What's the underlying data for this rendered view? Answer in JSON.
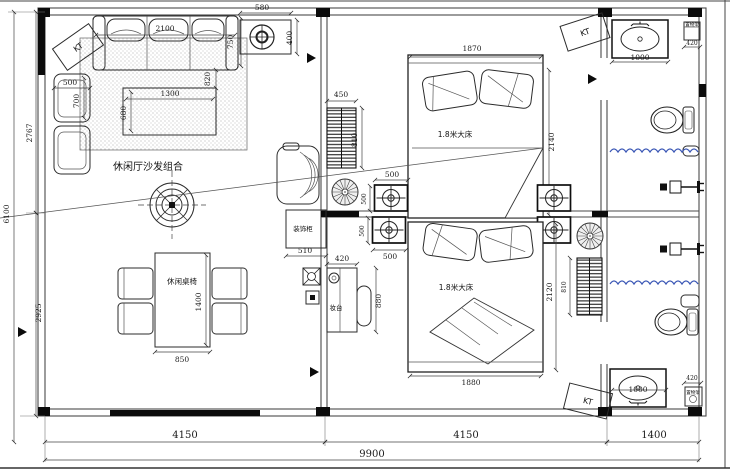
{
  "drawing": {
    "kt_labels": {
      "top_left": "KT",
      "top_right": "KT",
      "bottom_right": "KT"
    },
    "rooms": {
      "living": {
        "sofa_group_label": "休闲厅沙发组合",
        "dining_label": "休闲桌椅"
      },
      "bedroom1": {
        "bed_label": "1.8米大床"
      },
      "bedroom2": {
        "bed_label": "1.8米大床",
        "cabinet_label": "装饰柜",
        "dresser_label": "妆台"
      },
      "bath_top": {
        "shelf_label": "置物架"
      },
      "bath_bottom": {
        "shelf_label": "置物架"
      }
    },
    "dims": {
      "overall_width": "9900",
      "overall_height": "6100",
      "bottom_seg1": "4150",
      "bottom_seg2": "4150",
      "bottom_seg3": "1400",
      "left_upper": "2767",
      "left_lower": "2925",
      "sofa_width": "2100",
      "sofa_depth": "750",
      "sofa_gap": "820",
      "armchair_w": "500",
      "armchair_d": "700",
      "coffee_w": "1300",
      "coffee_d": "680",
      "fanbox_w": "580",
      "fanbox_h": "400",
      "rad1_w": "450",
      "rad1_h": "810",
      "bed1_w": "1870",
      "bed1_l": "2140",
      "ac_top": "500",
      "ac_bottom": "500",
      "ac_left_a": "500",
      "ac_left_b": "500",
      "cabinet_w": "510",
      "dresser_w": "420",
      "dresser_h": "880",
      "table_w": "850",
      "table_l": "1400",
      "bed2_w": "1880",
      "bed2_l": "2120",
      "rad2_h": "810",
      "vanity_top_w": "1000",
      "shelf_top_w": "420",
      "vanity_bottom_w": "1000",
      "shelf_bottom_w": "420"
    },
    "colors": {
      "line": "#2b2b2b",
      "wall_fill": "#0b0b0b",
      "curtain_blue": "#3a56b5",
      "hatch": "#8a8a8a"
    }
  }
}
